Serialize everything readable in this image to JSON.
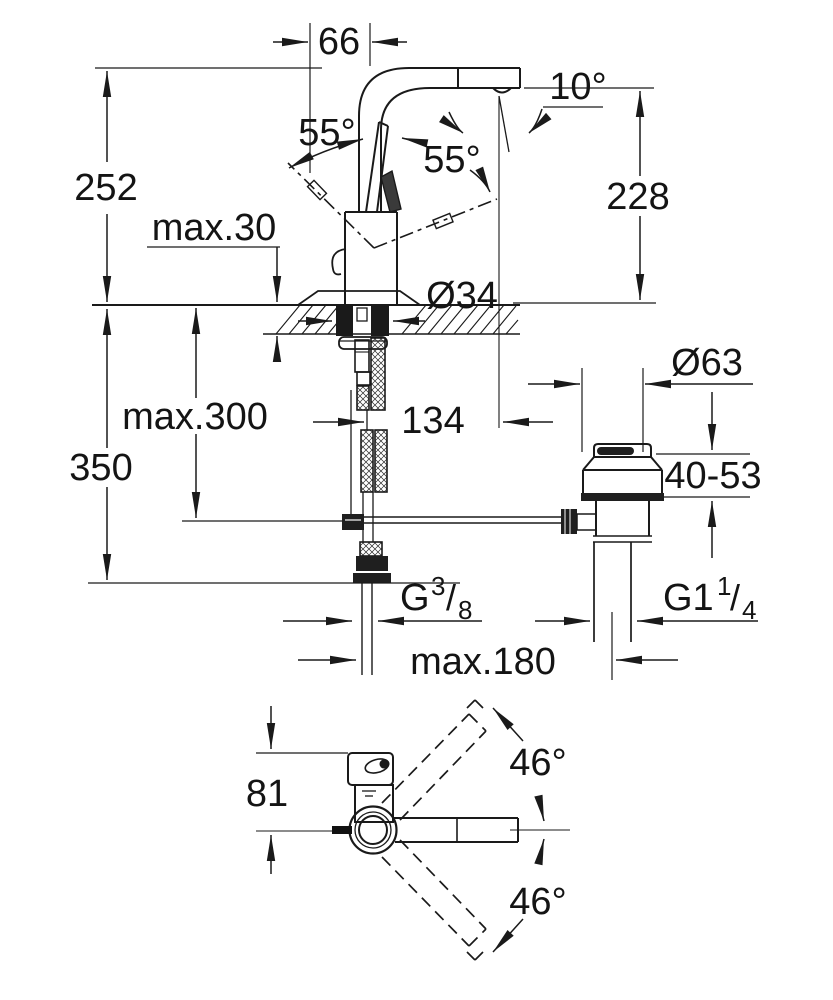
{
  "front_view": {
    "spout_projection": "66",
    "overall_height": "252",
    "outlet_height": "228",
    "aerator_angle": "10°",
    "lever_angle_left": "55°",
    "lever_angle_right": "55°",
    "max_deck_thickness": "max.30",
    "hole_diameter": "Ø34",
    "max_hose_depth": "max.300",
    "clearance_depth": "350",
    "outlet_offset": "134",
    "waste_flange_diameter": "Ø63",
    "waste_deck_range": "40-53",
    "supply_thread": {
      "base": "G",
      "sup": "3",
      "slash": "/",
      "sub": "8"
    },
    "waste_thread": {
      "base": "G1",
      "sup": "1",
      "slash": "/",
      "sub": "4"
    },
    "max_waste_offset": "max.180"
  },
  "top_view": {
    "head_depth": "81",
    "swivel_angle_upper": "46°",
    "swivel_angle_lower": "46°"
  },
  "colors": {
    "line": "#1a1a1a",
    "background": "#ffffff"
  }
}
